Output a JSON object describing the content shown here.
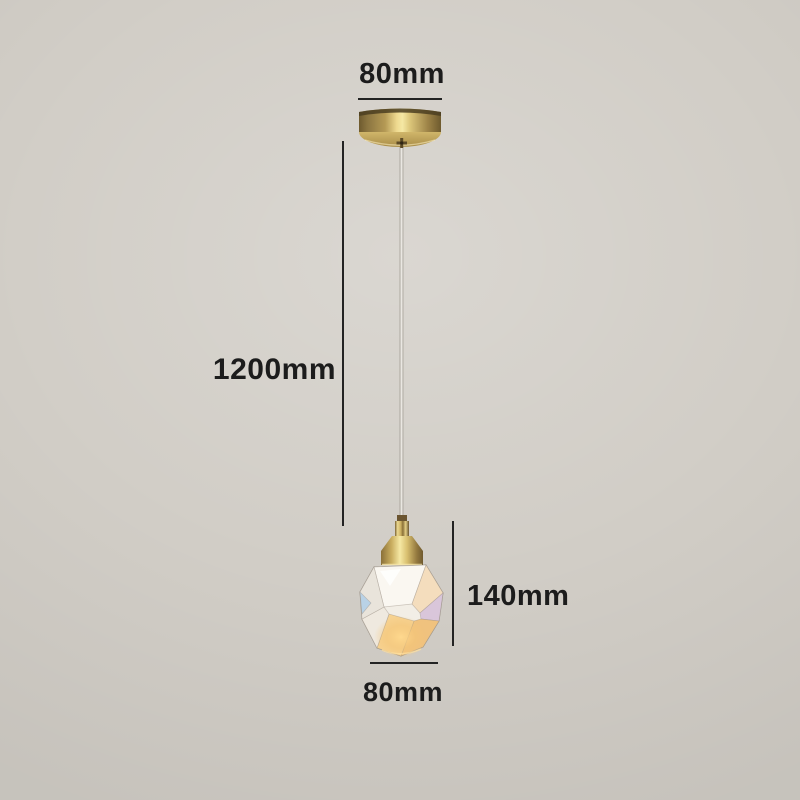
{
  "labels": {
    "canopy_width": "80mm",
    "cable_length": "1200mm",
    "pendant_height": "140mm",
    "pendant_width": "80mm"
  },
  "colors": {
    "background": "#d1cdc6",
    "dimension_text": "#1c1c1c",
    "dimension_line": "#232323",
    "brass_bright": "#f5e8a4",
    "brass_mid": "#b69a52",
    "brass_dark": "#6e5a2e",
    "crystal_base": "#f2eee6",
    "crystal_glow": "#f4c577",
    "cable_core": "#f7f5f0"
  },
  "parts": {
    "canopy": "ceiling-canopy",
    "cable": "suspension-cable",
    "socket": "lamp-socket",
    "shade": "crystal-shade"
  }
}
